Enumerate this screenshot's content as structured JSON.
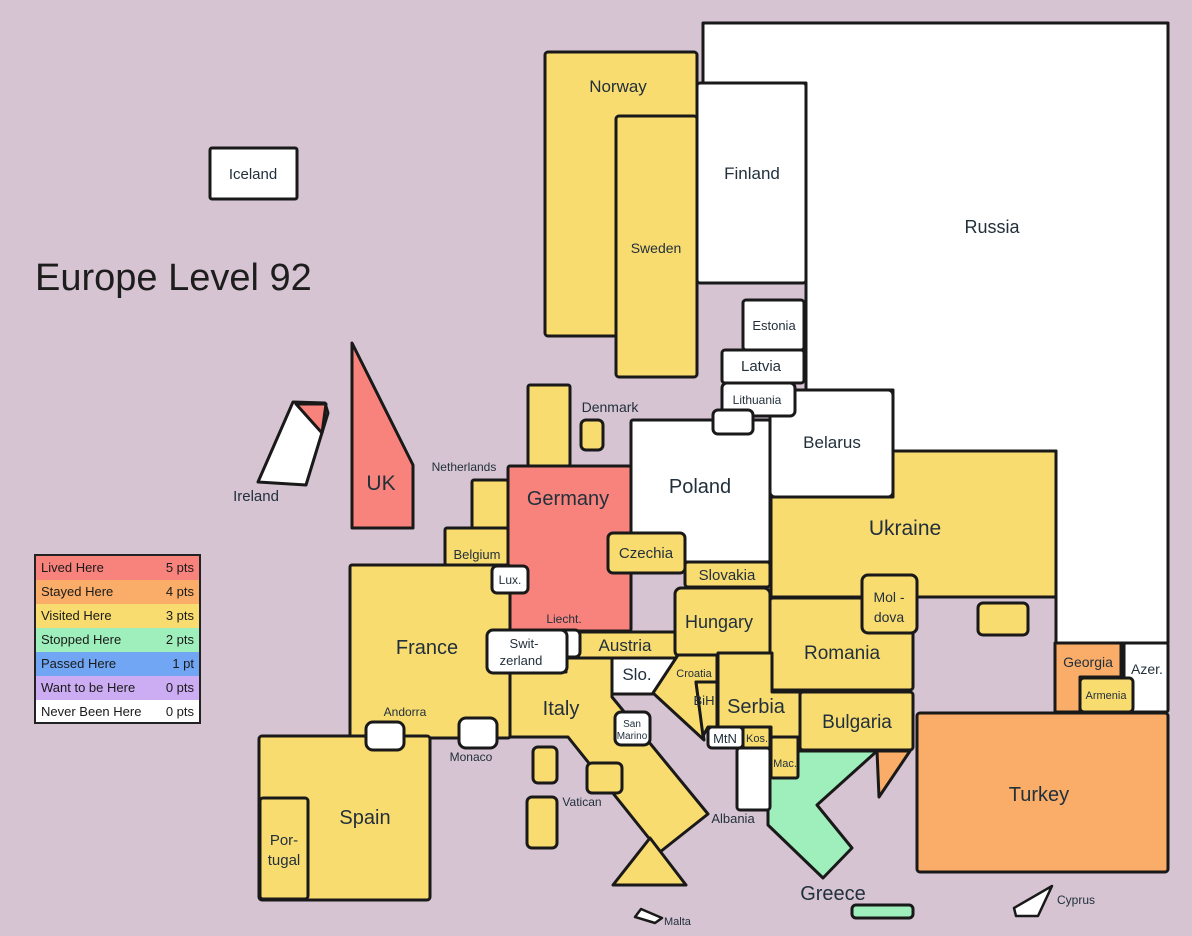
{
  "title": "Europe Level 92",
  "colors": {
    "background": "#D6C4D2",
    "border": "#191919",
    "lived": "#F8837C",
    "stayed": "#F9AD68",
    "visited": "#F9DC70",
    "stopped": "#9EEFBC",
    "passed": "#70A6F3",
    "want": "#CCACF2",
    "never": "#FFFFFF"
  },
  "legend": {
    "rows": [
      {
        "label": "Lived Here",
        "points": "5 pts",
        "color": "#F8837C"
      },
      {
        "label": "Stayed Here",
        "points": "4 pts",
        "color": "#F9AD68"
      },
      {
        "label": "Visited Here",
        "points": "3 pts",
        "color": "#F9DC70"
      },
      {
        "label": "Stopped Here",
        "points": "2 pts",
        "color": "#9EEFBC"
      },
      {
        "label": "Passed Here",
        "points": "1 pt",
        "color": "#70A6F3"
      },
      {
        "label": "Want to be Here",
        "points": "0 pts",
        "color": "#CCACF2"
      },
      {
        "label": "Never Been Here",
        "points": "0 pts",
        "color": "#FFFFFF"
      }
    ]
  },
  "countries": {
    "iceland": {
      "label": "Iceland"
    },
    "norway": {
      "label": "Norway"
    },
    "sweden": {
      "label": "Sweden"
    },
    "finland": {
      "label": "Finland"
    },
    "russia": {
      "label": "Russia"
    },
    "estonia": {
      "label": "Estonia"
    },
    "latvia": {
      "label": "Latvia"
    },
    "lithuania": {
      "label": "Lithuania"
    },
    "belarus": {
      "label": "Belarus"
    },
    "poland": {
      "label": "Poland"
    },
    "denmark": {
      "label": "Denmark"
    },
    "germany": {
      "label": "Germany"
    },
    "netherlands": {
      "label": "Netherlands"
    },
    "belgium": {
      "label": "Belgium"
    },
    "luxembourg": {
      "label": "Lux."
    },
    "france": {
      "label": "France"
    },
    "uk": {
      "label": "UK"
    },
    "ireland": {
      "label": "Ireland"
    },
    "switzerland": {
      "line1": "Swit-",
      "line2": "zerland"
    },
    "liechtenstein": {
      "label": "Liecht."
    },
    "austria": {
      "label": "Austria"
    },
    "czechia": {
      "label": "Czechia"
    },
    "slovakia": {
      "label": "Slovakia"
    },
    "hungary": {
      "label": "Hungary"
    },
    "slovenia": {
      "label": "Slo."
    },
    "croatia": {
      "label": "Croatia"
    },
    "bosnia": {
      "label": "BiH"
    },
    "serbia": {
      "label": "Serbia"
    },
    "montenegro": {
      "label": "MtN"
    },
    "kosovo": {
      "label": "Kos."
    },
    "macedonia": {
      "label": "Mac."
    },
    "albania": {
      "label": "Albania"
    },
    "greece": {
      "label": "Greece"
    },
    "malta": {
      "label": "Malta"
    },
    "cyprus": {
      "label": "Cyprus"
    },
    "italy": {
      "label": "Italy"
    },
    "san_marino": {
      "line1": "San",
      "line2": "Marino"
    },
    "vatican": {
      "label": "Vatican"
    },
    "monaco": {
      "label": "Monaco"
    },
    "andorra": {
      "label": "Andorra"
    },
    "spain": {
      "label": "Spain"
    },
    "portugal": {
      "line1": "Por-",
      "line2": "tugal"
    },
    "romania": {
      "label": "Romania"
    },
    "bulgaria": {
      "label": "Bulgaria"
    },
    "moldova": {
      "line1": "Mol -",
      "line2": "dova"
    },
    "ukraine": {
      "label": "Ukraine"
    },
    "turkey": {
      "label": "Turkey"
    },
    "georgia": {
      "label": "Georgia"
    },
    "armenia": {
      "label": "Armenia"
    },
    "azerbaijan": {
      "label": "Azer."
    }
  }
}
